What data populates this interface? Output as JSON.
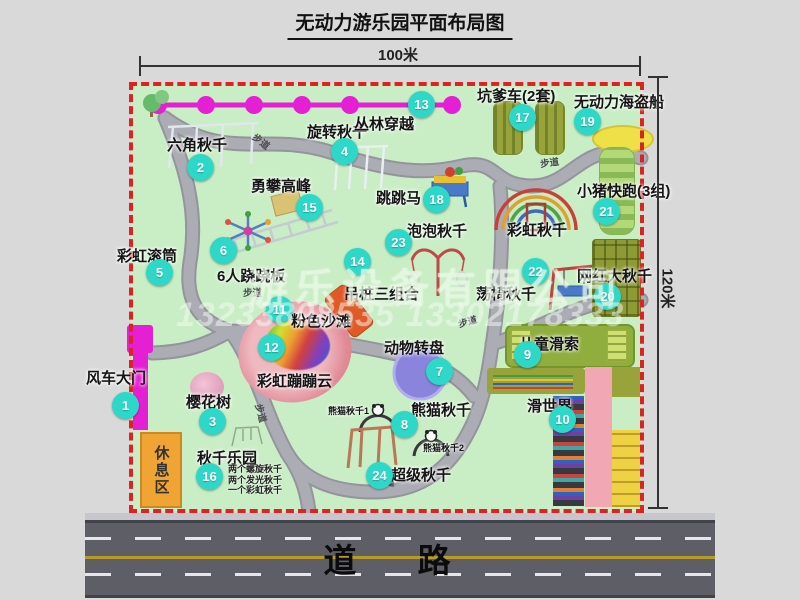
{
  "title": "无动力游乐园平面布局图",
  "dimensions": {
    "width": "100米",
    "height": "120米"
  },
  "road": {
    "label": "道 路"
  },
  "rest_area_label": "休息区",
  "walkway_label": "步道",
  "rainbow_swing_label": "彩虹秋千",
  "watermark": {
    "company": "游乐设备有限公司",
    "phone": "13233808535 13302178333"
  },
  "colors": {
    "marker_teal": "#2ed8c8",
    "zipline_magenta": "#e51fd4",
    "map_green": "#c9edc5",
    "border_red": "#dd2222",
    "road_gray": "#5e5e66",
    "rest_orange": "#f0a434",
    "pink_beach": "#e08a96"
  },
  "attractions": {
    "1": {
      "num": "1",
      "name": "风车大门"
    },
    "2": {
      "num": "2",
      "name": "六角秋千"
    },
    "3": {
      "num": "3",
      "name": "樱花树"
    },
    "4": {
      "num": "4",
      "name": "旋转秋千"
    },
    "5": {
      "num": "5",
      "name": "彩虹滚筒"
    },
    "6": {
      "num": "6",
      "name": "6人跷跷板"
    },
    "7": {
      "num": "7",
      "name": "动物转盘"
    },
    "8": {
      "num": "8",
      "name": "熊猫秋千",
      "sub1": "熊猫秋千1",
      "sub2": "熊猫秋千2"
    },
    "9": {
      "num": "9",
      "name": "儿童滑索"
    },
    "10": {
      "num": "10",
      "name": "滑世界"
    },
    "11": {
      "num": "11",
      "name": "粉色沙滩"
    },
    "12": {
      "num": "12",
      "name": "彩虹蹦蹦云"
    },
    "13": {
      "num": "13",
      "name": "丛林穿越"
    },
    "14": {
      "num": "14",
      "name": "吊桩三组合"
    },
    "15": {
      "num": "15",
      "name": "勇攀高峰"
    },
    "16": {
      "num": "16",
      "name": "秋千乐园",
      "note1": "两个螺旋秋千",
      "note2": "两个发光秋千",
      "note3": "一个彩虹秋千"
    },
    "17": {
      "num": "17",
      "name": "坑爹车(2套)"
    },
    "18": {
      "num": "18",
      "name": "跳跳马"
    },
    "19": {
      "num": "19",
      "name": "无动力海盗船"
    },
    "20": {
      "num": "20",
      "name": "网红大秋千"
    },
    "21": {
      "num": "21",
      "name": "小猪快跑(3组)"
    },
    "22": {
      "num": "22",
      "name": "荡椅秋千"
    },
    "23": {
      "num": "23",
      "name": "泡泡秋千"
    },
    "24": {
      "num": "24",
      "name": "超级秋千"
    }
  }
}
